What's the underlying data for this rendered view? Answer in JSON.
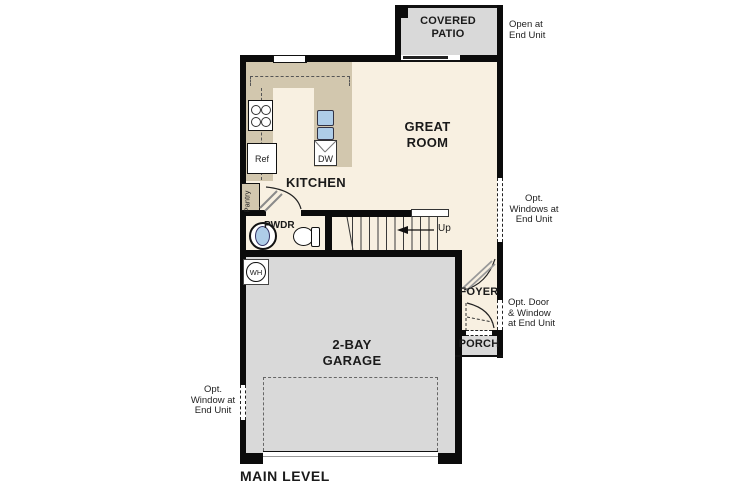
{
  "title": "MAIN LEVEL",
  "rooms": {
    "covered_patio": [
      "COVERED",
      "PATIO"
    ],
    "great_room": [
      "GREAT",
      "ROOM"
    ],
    "kitchen": "KITCHEN",
    "powder": "PWDR",
    "foyer": "FOYER",
    "porch": "PORCH",
    "garage": [
      "2-BAY",
      "GARAGE"
    ]
  },
  "fixtures": {
    "refrigerator": "Ref",
    "dishwasher": "DW",
    "pantry": "Pantry",
    "water_heater": "WH",
    "stairs_direction": "Up"
  },
  "annotations": {
    "patio_note": [
      "Open at",
      "End Unit"
    ],
    "right_windows_note": [
      "Opt.",
      "Windows at",
      "End Unit"
    ],
    "entry_note": [
      "Opt. Door",
      "& Window",
      "at End Unit"
    ],
    "garage_window_note": [
      "Opt.",
      "Window at",
      "End Unit"
    ]
  },
  "colors": {
    "wall": "#0b0b0b",
    "interior_floor": "#f8f0e1",
    "counter": "#d2c7ae",
    "concrete": "#d9d9d9",
    "fixture_blue": "#aecde8"
  }
}
